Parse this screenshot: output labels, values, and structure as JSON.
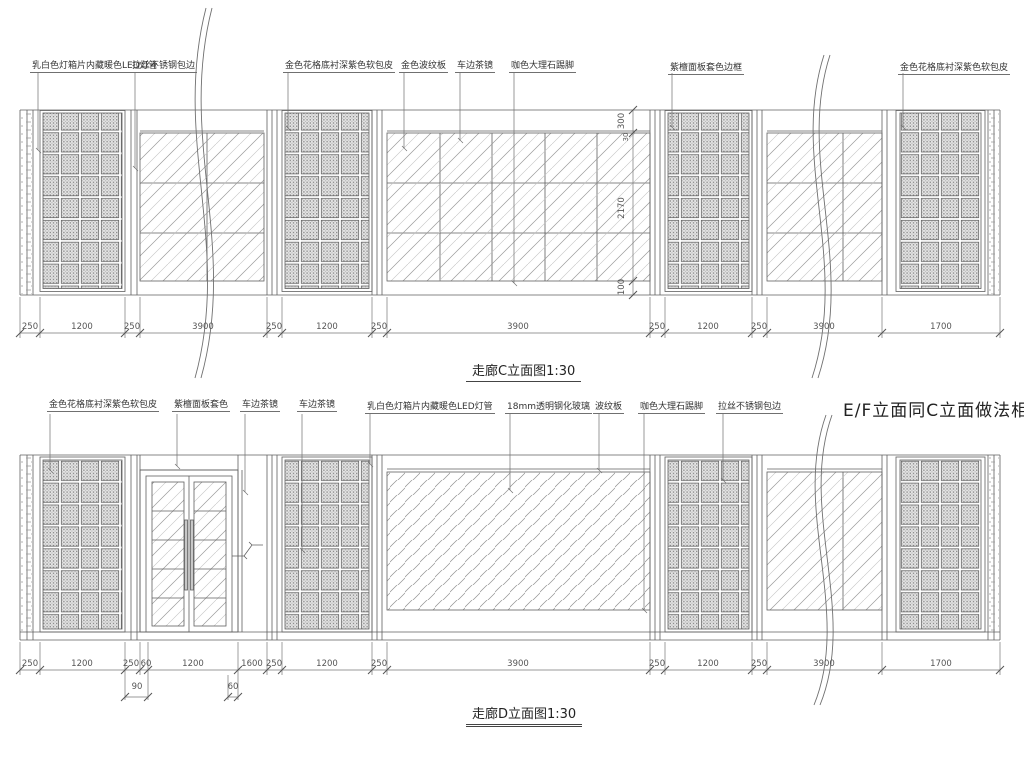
{
  "drawing": {
    "titles": {
      "top": "走廊C立面图1:30",
      "bottom": "走廊D立面图1:30",
      "note_right": "E/F立面同C立面做法相同"
    },
    "top_elevation": {
      "labels": [
        "乳白色灯箱片内藏暖色LED灯管",
        "拉丝不锈钢包边",
        "金色花格底衬深紫色软包皮",
        "金色波纹板",
        "车边茶镜",
        "咖色大理石踢脚",
        "紫檀面板套色边框",
        "金色花格底衬深紫色软包皮"
      ],
      "dims": [
        "250",
        "1200",
        "250",
        "3900",
        "250",
        "1200",
        "250",
        "3900",
        "250",
        "1200",
        "250",
        "3900",
        "1700"
      ],
      "vdims": [
        "300",
        "30",
        "2170",
        "100"
      ]
    },
    "bottom_elevation": {
      "labels": [
        "金色花格底衬深紫色软包皮",
        "紫檀面板套色",
        "车边茶镜",
        "车边茶镜",
        "乳白色灯箱片内藏暖色LED灯管",
        "18mm透明钢化玻璃",
        "波纹板",
        "咖色大理石踢脚",
        "拉丝不锈钢包边"
      ],
      "dims": [
        "250",
        "1200",
        "250",
        "60",
        "1200",
        "1600",
        "250",
        "1200",
        "250",
        "3900",
        "250",
        "1200",
        "250",
        "3900",
        "1700"
      ],
      "subdims": [
        "90",
        "60"
      ]
    },
    "colors": {
      "line": "#606060",
      "hatch": "#9a9a9a",
      "text": "#333333",
      "background": "#ffffff"
    }
  }
}
